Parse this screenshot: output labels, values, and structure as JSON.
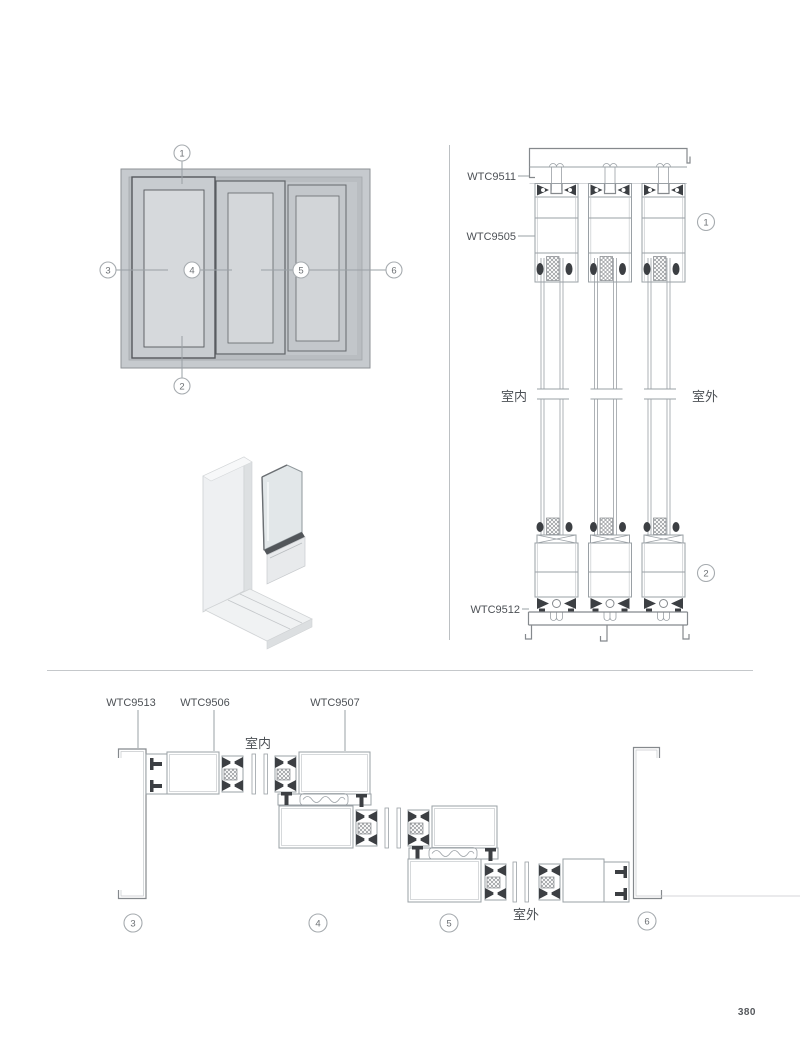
{
  "page": {
    "number": "380"
  },
  "colors": {
    "line": "#9aa0a5",
    "line_dark": "#85898d",
    "gasket": "#3c3f43",
    "frame_fill": "#c6cace",
    "recess_fill": "#b9bdc1",
    "glass_fill": "#d6d9dc",
    "label_text": "#4d5156",
    "divider": "#c5c8cb"
  },
  "elevation": {
    "callouts": [
      "1",
      "2",
      "3",
      "4",
      "5",
      "6"
    ]
  },
  "vertical_section": {
    "labels": {
      "head_frame": "WTC9511",
      "sash": "WTC9505",
      "sill_frame": "WTC9512"
    },
    "indoor": "室内",
    "outdoor": "室外",
    "callouts": [
      "1",
      "2"
    ]
  },
  "horizontal_section": {
    "labels": {
      "jamb": "WTC9513",
      "sash": "WTC9506",
      "interlock": "WTC9507"
    },
    "indoor": "室内",
    "outdoor": "室外",
    "callouts": [
      "3",
      "4",
      "5",
      "6"
    ]
  }
}
